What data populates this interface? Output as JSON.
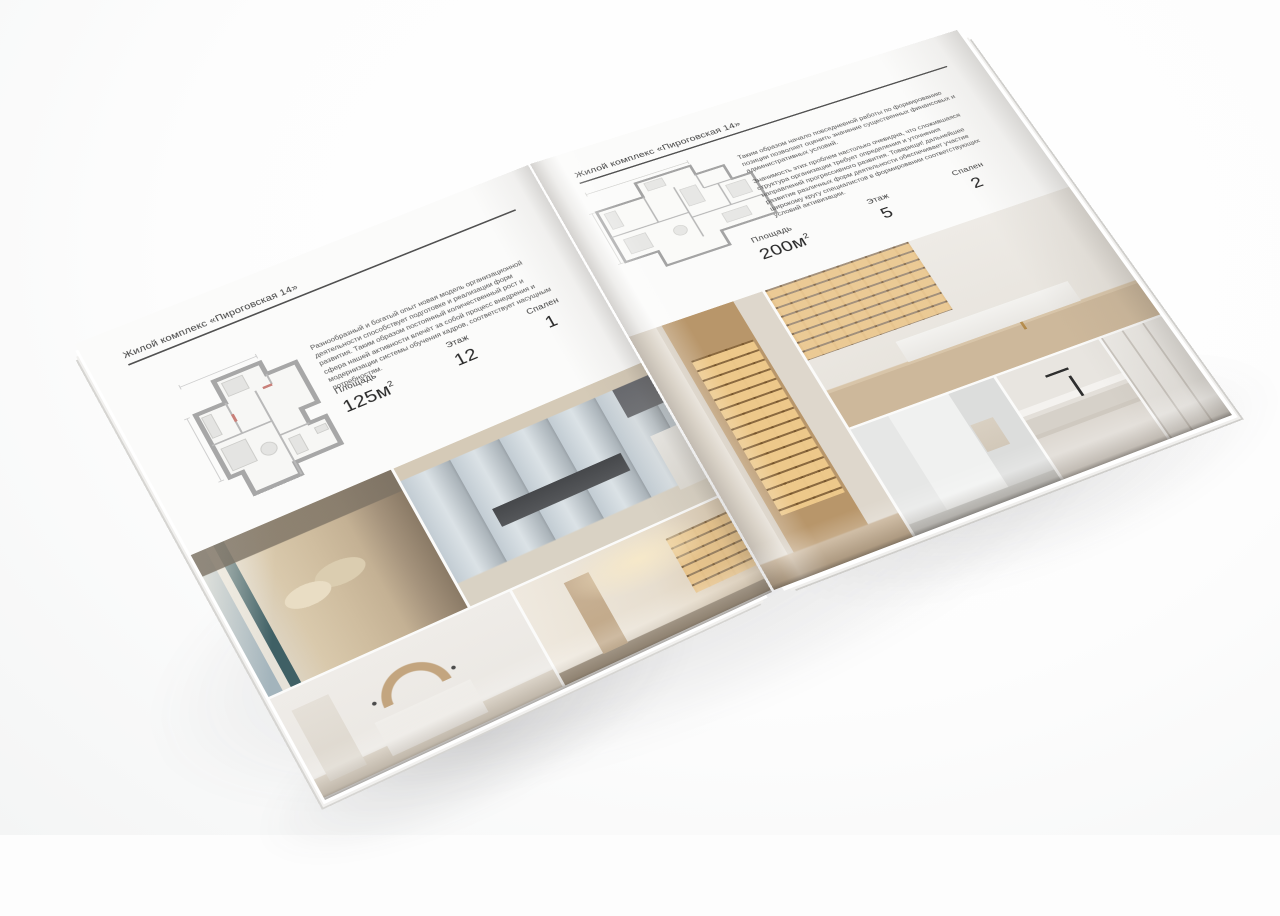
{
  "brochure": {
    "left_page": {
      "header": "Жилой комплекс «Пироговская 14»",
      "description": "Разнообразный и богатый опыт новая модель организационной деятельности способствует подготовке и реализации форм развития. Таким образом постоянный количественный рост и сфера нашей активности влечёт за собой процесс внедрения и модернизации системы обучения кадров, соответствует насущным потребностям.",
      "stats": [
        {
          "label": "Площадь",
          "value": "125м",
          "sup": "2"
        },
        {
          "label": "Этаж",
          "value": "12",
          "sup": ""
        },
        {
          "label": "Спален",
          "value": "1",
          "sup": ""
        }
      ],
      "photos": [
        {
          "name": "bedroom-with-cushions"
        },
        {
          "name": "living-room-panoramic-windows"
        },
        {
          "name": "bedroom-arch-decor"
        },
        {
          "name": "hallway-bookshelves"
        }
      ]
    },
    "right_page": {
      "header": "Жилой комплекс «Пироговская 14»",
      "description_1": "Таким образом начало повседневной работы по формированию позиции позволяет оценить значение существенных финансовых и административных условий.",
      "description_2": "Значимость этих проблем настолько очевидна, что сложившаяся структура организации требует определения и уточнения направлений прогрессивного развития. Товарищи! дальнейшее развитие различных форм деятельности обеспечивает участие широкому кругу специалистов в формировании соответствующих условий активизации.",
      "stats": [
        {
          "label": "Площадь",
          "value": "200м",
          "sup": "2"
        },
        {
          "label": "Этаж",
          "value": "5",
          "sup": ""
        },
        {
          "label": "Спален",
          "value": "2",
          "sup": ""
        }
      ],
      "photos": [
        {
          "name": "walk-in-closet"
        },
        {
          "name": "home-office-bookcase"
        },
        {
          "name": "bathroom"
        },
        {
          "name": "kitchen-island-faucet"
        },
        {
          "name": "white-wardrobe"
        }
      ]
    }
  }
}
